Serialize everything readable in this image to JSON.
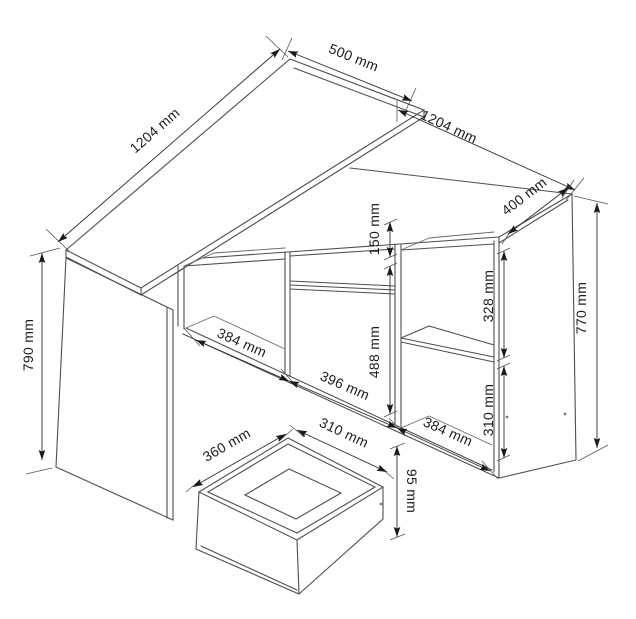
{
  "diagram": {
    "type": "furniture-dimension-drawing",
    "views": [
      "corner-desk-with-cabinet",
      "pull-out-drawer-detail"
    ],
    "dimensions": {
      "desk_length": "1204 mm",
      "desk_depth": "500 mm",
      "desk_height": "790 mm",
      "cabinet_length": "1204 mm",
      "cabinet_depth": "400 mm",
      "cabinet_height": "770 mm",
      "drawer_front_height": "150 mm",
      "door_height": "488 mm",
      "upper_compartment_height": "328 mm",
      "lower_compartment_height": "310 mm",
      "left_compartment_width": "384 mm",
      "door_width": "396 mm",
      "right_compartment_width": "384 mm",
      "drawer_depth": "360 mm",
      "drawer_width": "310 mm",
      "drawer_box_height": "95 mm"
    }
  }
}
